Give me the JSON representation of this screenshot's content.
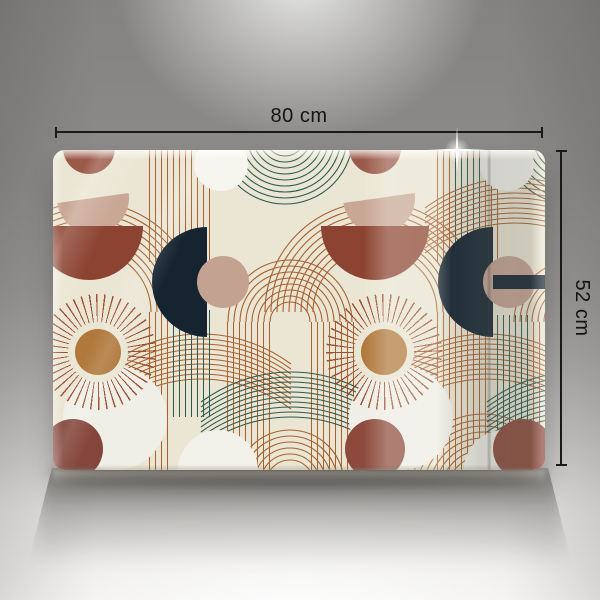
{
  "annotations": {
    "width_label": "80 cm",
    "height_label": "52 cm"
  },
  "product": {
    "type_hint": "glass board with boho arch pattern"
  },
  "palette": {
    "backdrop_gray": "#8d8c8a",
    "floor_light": "#f0efed",
    "panel_cream": "#ebe6d4",
    "terracotta_dark": "#8c4331",
    "terracotta": "#9b5a49",
    "blush": "#c9a795",
    "blush_circle": "#c4a292",
    "navy": "#152430",
    "ochre": "#b0783b",
    "sun_ray": "#9c5030",
    "line_terracotta": "#a7602f",
    "line_teal": "#2c5a50",
    "shape_white": "#f2f1e9",
    "mauve": "#8a4a3d",
    "dimension_line": "#1a1a1a"
  }
}
